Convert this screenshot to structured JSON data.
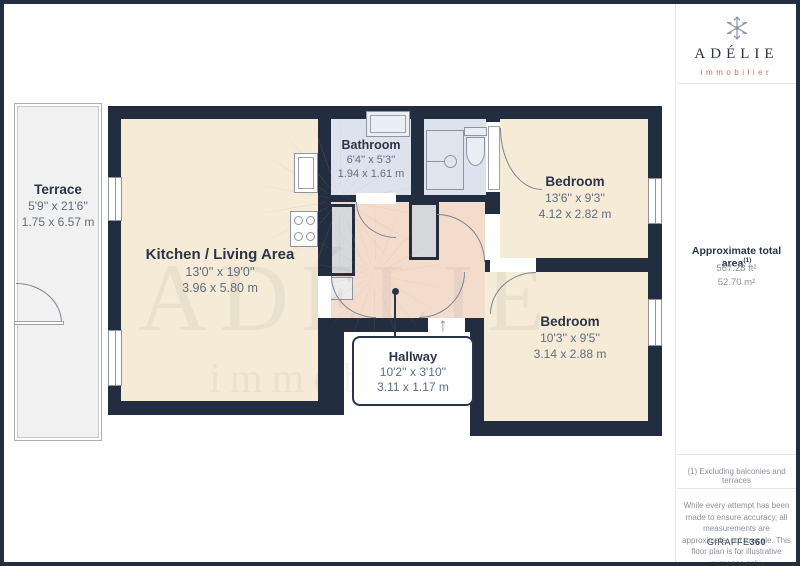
{
  "branding": {
    "name": "ADÉLIE",
    "tagline": "immobilier"
  },
  "watermark": {
    "line1": "ADÉLIE",
    "line2": "immobilier"
  },
  "rooms": [
    {
      "name": "Terrace",
      "imperial": "5'9'' x 21'6''",
      "metric": "1.75 x 6.57 m"
    },
    {
      "name": "Kitchen / Living Area",
      "imperial": "13'0'' x 19'0''",
      "metric": "3.96 x 5.80 m"
    },
    {
      "name": "Bathroom",
      "imperial": "6'4'' x 5'3''",
      "metric": "1.94 x 1.61 m"
    },
    {
      "name": "Bedroom",
      "imperial": "13'6'' x 9'3''",
      "metric": "4.12 x 2.82 m"
    },
    {
      "name": "Bedroom",
      "imperial": "10'3'' x 9'5''",
      "metric": "3.14 x 2.88 m"
    },
    {
      "name": "Hallway",
      "imperial": "10'2'' x 3'10''",
      "metric": "3.11 x 1.17 m"
    }
  ],
  "sidebar": {
    "area_title": "Approximate total area",
    "area_sup": "(1)",
    "area_ft": "567.28 ft²",
    "area_m": "52.70 m²",
    "footnote": "(1) Excluding balconies and terraces",
    "disclaimer": "While every attempt has been made to ensure accuracy, all measurements are approximate, not to scale. This floor plan is for illustrative purposes only.",
    "brand_left": "GIRAFFE",
    "brand_right": "360"
  },
  "entry_arrow": "↑",
  "colors": {
    "wall": "#222d3f",
    "room_cream": "#f5ebd6",
    "hallway_peach": "#f4dccd",
    "bathroom_blue": "#dde3ee",
    "terrace_gray": "#f1f1f1",
    "logo_coral": "#c0766b",
    "label_navy": "#2b3547",
    "dim_gray": "#5f6e80"
  }
}
